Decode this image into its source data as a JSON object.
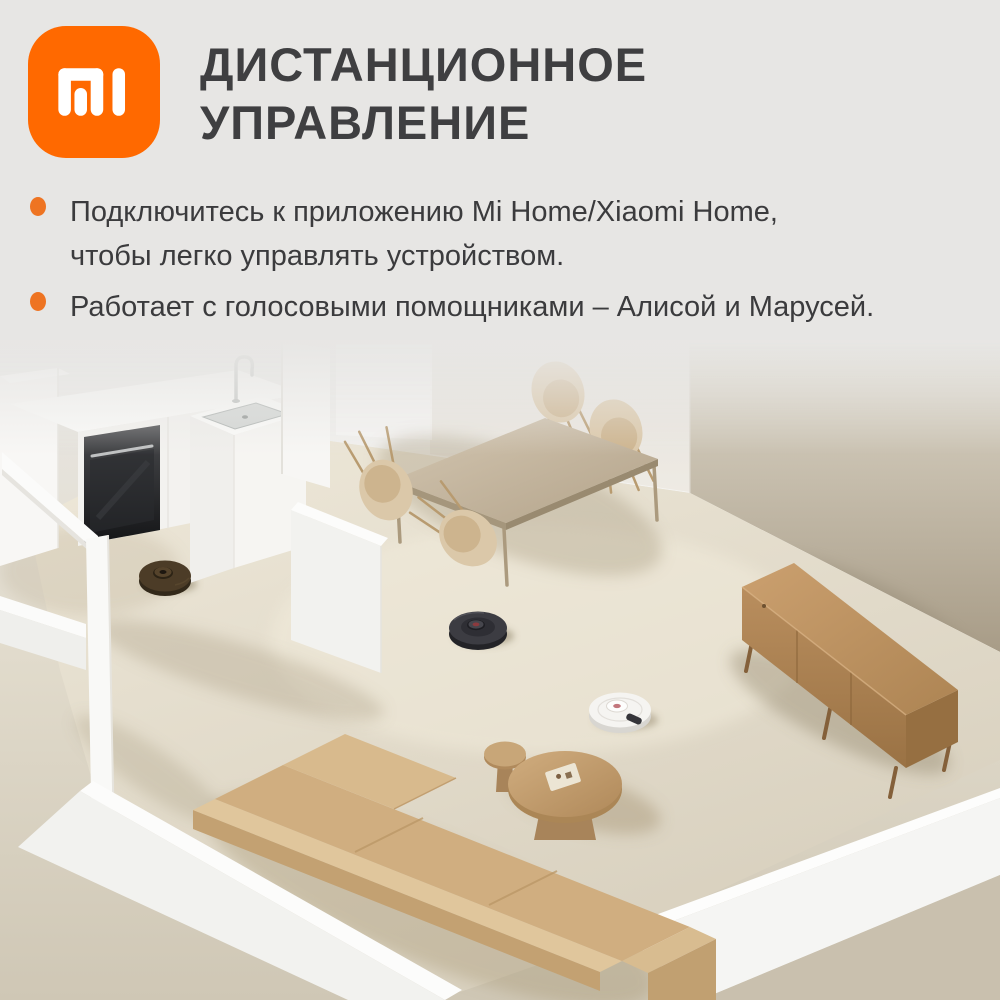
{
  "brand": {
    "name": "mi-logo",
    "logo_bg_color": "#ff6900",
    "logo_glyph_color": "#ffffff"
  },
  "header": {
    "title_line1": "ДИСТАНЦИОННОЕ",
    "title_line2": "УПРАВЛЕНИЕ",
    "title_color": "#3f3f41"
  },
  "bullets": {
    "marker_color": "#ee7422",
    "items": [
      {
        "lines": [
          "Подключитесь к приложению Mi Home/Xiaomi Home,",
          "чтобы легко управлять устройством."
        ]
      },
      {
        "lines": [
          "Работает с голосовыми помощниками – Алисой и Марусей."
        ]
      }
    ]
  },
  "scene": {
    "kind": "isometric-apartment-3d-render",
    "objects": [
      "kitchen-counter",
      "built-in-oven",
      "kitchen-sink-unit",
      "faucet",
      "door-frame",
      "half-walls",
      "dining-table",
      "dining-chairs-x4",
      "tv-stand-wood",
      "l-shaped-sofa",
      "round-coffee-tables",
      "serving-tray",
      "robot-vacuum-bronze-kitchen",
      "robot-vacuum-black-center",
      "robot-vacuum-white"
    ],
    "palette": {
      "floor": "#e7e0d0",
      "taupe_wall": "#b0a48e",
      "white_walls": "#f5f4f1",
      "wood_furniture": "#b68c5c",
      "sofa_fabric": "#d0ae80",
      "robot_black": "#3c3c42",
      "robot_white": "#f5f4f1"
    }
  }
}
